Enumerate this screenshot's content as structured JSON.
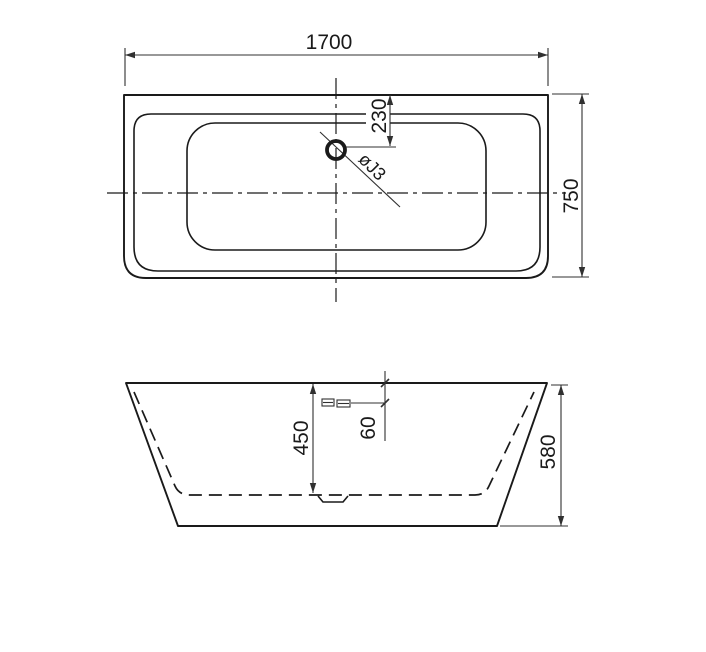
{
  "page": {
    "background": "#ffffff",
    "line_color": "#1a1a1a"
  },
  "top_view": {
    "labels": {
      "length": "1700",
      "width": "750",
      "drain_offset": "230",
      "drain_diameter": "øJ3"
    }
  },
  "front_view": {
    "labels": {
      "inner_depth": "450",
      "overflow_offset": "60",
      "height": "580"
    }
  }
}
